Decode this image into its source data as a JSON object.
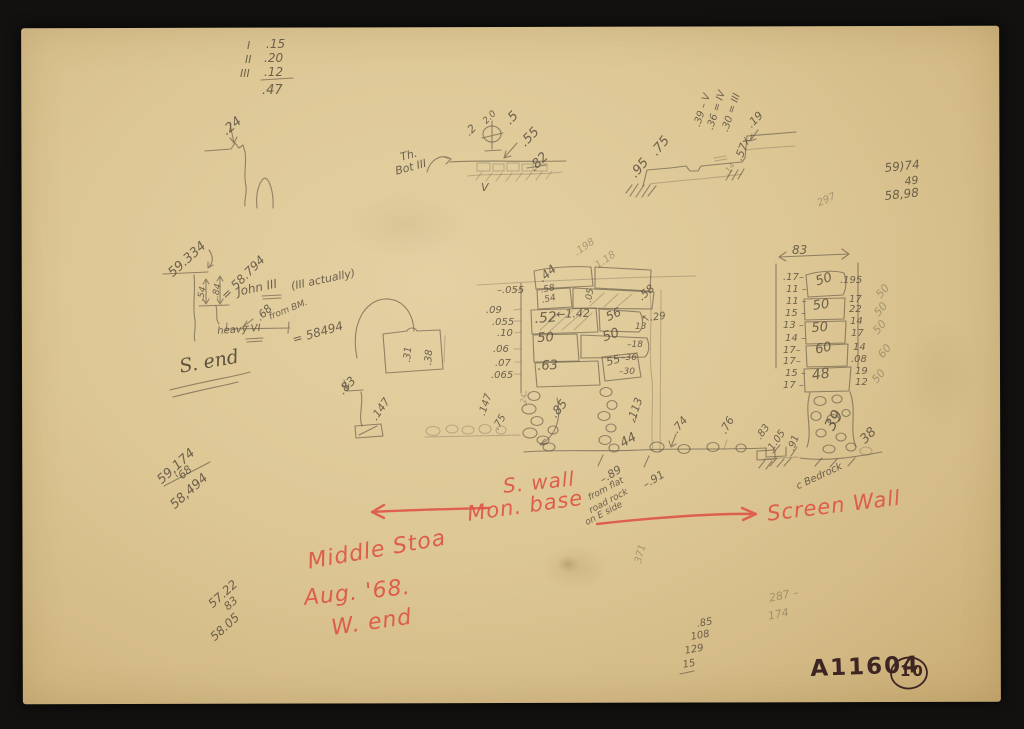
{
  "document": {
    "type": "scanned handwritten field-note sketch page",
    "catalog_number": "A11604",
    "page_number": "10",
    "red_labels": [
      "S. wall",
      "Mon. base",
      "Screen Wall",
      "Middle Stoa",
      "Aug. '68.",
      "W. end"
    ],
    "colors": {
      "paper": "#ddc795",
      "pencil": "#5e5344",
      "red": "#dd5244",
      "ink": "#3c2522",
      "background": "#12110f"
    }
  },
  "annotations": [
    {
      "t": "I",
      "x": 247,
      "y": 40,
      "s": 11
    },
    {
      "t": ".15",
      "x": 266,
      "y": 38,
      "s": 12
    },
    {
      "t": "II",
      "x": 245,
      "y": 54,
      "s": 11
    },
    {
      "t": ".20",
      "x": 264,
      "y": 52,
      "s": 12
    },
    {
      "t": "III",
      "x": 240,
      "y": 68,
      "s": 11
    },
    {
      "t": ".12",
      "x": 264,
      "y": 66,
      "s": 12
    },
    {
      "t": ".47",
      "x": 262,
      "y": 84,
      "s": 13
    },
    {
      "t": ".24",
      "x": 220,
      "y": 128,
      "r": -40,
      "s": 13
    },
    {
      "t": "Th.",
      "x": 399,
      "y": 152,
      "r": -15,
      "s": 11
    },
    {
      "t": "Bot III",
      "x": 394,
      "y": 166,
      "r": -15,
      "s": 11
    },
    {
      "t": ".2",
      "x": 463,
      "y": 130,
      "r": -45,
      "s": 11
    },
    {
      "t": "2.0",
      "x": 482,
      "y": 120,
      "r": -45,
      "s": 9
    },
    {
      "t": ".5",
      "x": 503,
      "y": 118,
      "r": -45,
      "s": 13
    },
    {
      "t": ".55",
      "x": 518,
      "y": 140,
      "r": -45,
      "s": 13
    },
    {
      "t": ".82",
      "x": 527,
      "y": 165,
      "r": -45,
      "s": 13
    },
    {
      "t": "V",
      "x": 481,
      "y": 182,
      "s": 11
    },
    {
      "t": ".95",
      "x": 628,
      "y": 172,
      "r": -50,
      "s": 13
    },
    {
      "t": ".75",
      "x": 649,
      "y": 150,
      "r": -50,
      "s": 13
    },
    {
      "t": ".39 – V",
      "x": 693,
      "y": 125,
      "r": -72,
      "s": 10
    },
    {
      "t": ".36 = IV",
      "x": 706,
      "y": 128,
      "r": -72,
      "s": 10
    },
    {
      "t": ".30 = III",
      "x": 721,
      "y": 130,
      "r": -72,
      "s": 10
    },
    {
      "t": ".57x",
      "x": 733,
      "y": 158,
      "r": -68,
      "s": 11
    },
    {
      "t": ".19",
      "x": 745,
      "y": 122,
      "r": -45,
      "s": 11
    },
    {
      "t": ".14",
      "x": 723,
      "y": 172,
      "r": -55,
      "s": 8,
      "c": "pf"
    },
    {
      "t": "59)74",
      "x": 884,
      "y": 162,
      "r": -6,
      "s": 12
    },
    {
      "t": "49",
      "x": 904,
      "y": 176,
      "r": -6,
      "s": 11
    },
    {
      "t": "58,98",
      "x": 884,
      "y": 190,
      "r": -6,
      "s": 12
    },
    {
      "t": "297",
      "x": 816,
      "y": 200,
      "r": -25,
      "s": 10,
      "c": "pf"
    },
    {
      "t": "59.334",
      "x": 166,
      "y": 270,
      "r": -42,
      "s": 13
    },
    {
      "t": ".54",
      "x": 197,
      "y": 300,
      "r": -78,
      "s": 9
    },
    {
      "t": ".84",
      "x": 212,
      "y": 297,
      "r": -78,
      "s": 9
    },
    {
      "t": "= 58.794",
      "x": 219,
      "y": 293,
      "r": -45,
      "s": 12
    },
    {
      "t": "John III",
      "x": 236,
      "y": 286,
      "r": -12,
      "s": 12
    },
    {
      "t": "(III actually)",
      "x": 290,
      "y": 281,
      "r": -12,
      "s": 11
    },
    {
      "t": ".68",
      "x": 254,
      "y": 315,
      "r": -45,
      "s": 11
    },
    {
      "t": "from BM.",
      "x": 268,
      "y": 314,
      "r": -22,
      "s": 9
    },
    {
      "t": "= 58494",
      "x": 291,
      "y": 334,
      "r": -16,
      "s": 12
    },
    {
      "t": "heavy VI",
      "x": 217,
      "y": 327,
      "r": -4,
      "s": 10
    },
    {
      "t": "S. end",
      "x": 178,
      "y": 358,
      "r": -10,
      "s": 19,
      "c": "ps",
      "n": "label-s-end"
    },
    {
      "t": ".31",
      "x": 403,
      "y": 362,
      "r": -85,
      "s": 10
    },
    {
      "t": ".38",
      "x": 424,
      "y": 365,
      "r": -85,
      "s": 10
    },
    {
      "t": ".83",
      "x": 336,
      "y": 388,
      "r": -45,
      "s": 12
    },
    {
      "t": ".147",
      "x": 369,
      "y": 416,
      "r": -55,
      "s": 11
    },
    {
      "t": "–.055",
      "x": 497,
      "y": 286,
      "s": 10
    },
    {
      "t": ".09",
      "x": 486,
      "y": 306,
      "s": 10
    },
    {
      "t": ".055",
      "x": 492,
      "y": 318,
      "s": 10
    },
    {
      "t": ".10",
      "x": 497,
      "y": 329,
      "s": 10
    },
    {
      "t": ".06",
      "x": 493,
      "y": 345,
      "s": 10
    },
    {
      "t": ".07",
      "x": 495,
      "y": 359,
      "s": 10
    },
    {
      "t": ".065",
      "x": 491,
      "y": 371,
      "s": 10
    },
    {
      "t": ".44",
      "x": 536,
      "y": 275,
      "r": -40,
      "s": 12
    },
    {
      "t": ".198",
      "x": 573,
      "y": 250,
      "r": -35,
      "s": 10,
      "c": "pf"
    },
    {
      "t": "1.18",
      "x": 594,
      "y": 263,
      "r": -35,
      "s": 10,
      "c": "pf"
    },
    {
      "t": ".58",
      "x": 540,
      "y": 287,
      "r": -12,
      "s": 9
    },
    {
      "t": ".54",
      "x": 541,
      "y": 297,
      "r": -12,
      "s": 9
    },
    {
      "t": ".05",
      "x": 585,
      "y": 302,
      "r": -80,
      "s": 9
    },
    {
      "t": ".52",
      "x": 534,
      "y": 312,
      "r": -4,
      "s": 14
    },
    {
      "t": "←1.42",
      "x": 556,
      "y": 309,
      "r": -2,
      "s": 11
    },
    {
      "t": "56",
      "x": 604,
      "y": 312,
      "r": -25,
      "s": 12
    },
    {
      "t": "↖.29",
      "x": 641,
      "y": 315,
      "r": -8,
      "s": 10
    },
    {
      "t": ".58",
      "x": 636,
      "y": 294,
      "r": -40,
      "s": 11
    },
    {
      "t": "50",
      "x": 537,
      "y": 332,
      "r": -3,
      "s": 13
    },
    {
      "t": "50",
      "x": 601,
      "y": 332,
      "r": -20,
      "s": 13
    },
    {
      "t": "13",
      "x": 635,
      "y": 323,
      "s": 9
    },
    {
      "t": "–18",
      "x": 627,
      "y": 341,
      "s": 9
    },
    {
      "t": ".63",
      "x": 537,
      "y": 360,
      "r": -3,
      "s": 13
    },
    {
      "t": "55",
      "x": 605,
      "y": 357,
      "r": -15,
      "s": 11
    },
    {
      "t": "–36",
      "x": 621,
      "y": 354,
      "s": 9
    },
    {
      "t": "–30",
      "x": 619,
      "y": 368,
      "s": 9
    },
    {
      "t": ".85",
      "x": 548,
      "y": 412,
      "r": -50,
      "s": 12
    },
    {
      "t": ".147",
      "x": 478,
      "y": 414,
      "r": -72,
      "s": 10
    },
    {
      "t": ".75",
      "x": 492,
      "y": 427,
      "r": -60,
      "s": 10
    },
    {
      "t": ".24",
      "x": 520,
      "y": 405,
      "r": -85,
      "s": 7,
      "c": "pf"
    },
    {
      "t": "113",
      "x": 627,
      "y": 416,
      "r": -70,
      "s": 11
    },
    {
      "t": "√",
      "x": 632,
      "y": 417,
      "s": 9
    },
    {
      "t": "44",
      "x": 618,
      "y": 439,
      "r": -30,
      "s": 13
    },
    {
      "t": ".74",
      "x": 670,
      "y": 428,
      "r": -50,
      "s": 11
    },
    {
      "t": ".76",
      "x": 718,
      "y": 430,
      "r": -60,
      "s": 11
    },
    {
      "t": ".83",
      "x": 755,
      "y": 436,
      "r": -55,
      "s": 10
    },
    {
      "t": "1.05",
      "x": 767,
      "y": 447,
      "r": -55,
      "s": 10
    },
    {
      "t": ".91",
      "x": 787,
      "y": 449,
      "r": -70,
      "s": 10
    },
    {
      "t": "–.89",
      "x": 598,
      "y": 476,
      "r": -32,
      "s": 11
    },
    {
      "t": "–.91",
      "x": 641,
      "y": 481,
      "r": -32,
      "s": 11
    },
    {
      "t": "from flat",
      "x": 587,
      "y": 495,
      "r": -28,
      "s": 9
    },
    {
      "t": "road rock",
      "x": 588,
      "y": 508,
      "r": -28,
      "s": 9
    },
    {
      "t": "on E side",
      "x": 584,
      "y": 520,
      "r": -28,
      "s": 9
    },
    {
      "t": "83",
      "x": 792,
      "y": 244,
      "s": 12
    },
    {
      "t": ".17–",
      "x": 783,
      "y": 273,
      "s": 10
    },
    {
      "t": "11 –",
      "x": 786,
      "y": 285,
      "s": 10
    },
    {
      "t": "11 –",
      "x": 786,
      "y": 297,
      "s": 10
    },
    {
      "t": "15 –",
      "x": 785,
      "y": 309,
      "s": 10
    },
    {
      "t": "13 –",
      "x": 783,
      "y": 321,
      "s": 10
    },
    {
      "t": "14 –",
      "x": 785,
      "y": 334,
      "s": 10
    },
    {
      "t": "17–",
      "x": 783,
      "y": 346,
      "s": 10
    },
    {
      "t": "17–",
      "x": 783,
      "y": 357,
      "s": 10
    },
    {
      "t": "15 –",
      "x": 785,
      "y": 369,
      "s": 10
    },
    {
      "t": "17 –",
      "x": 783,
      "y": 381,
      "s": 10
    },
    {
      "t": "50",
      "x": 814,
      "y": 276,
      "r": -18,
      "s": 13
    },
    {
      "t": "50",
      "x": 812,
      "y": 300,
      "r": -8,
      "s": 13
    },
    {
      "t": "50",
      "x": 811,
      "y": 322,
      "r": -4,
      "s": 13
    },
    {
      "t": "60",
      "x": 814,
      "y": 344,
      "r": -12,
      "s": 13
    },
    {
      "t": "48",
      "x": 811,
      "y": 369,
      "r": -8,
      "s": 14
    },
    {
      "t": "39",
      "x": 822,
      "y": 425,
      "r": -60,
      "s": 16
    },
    {
      "t": ".195",
      "x": 840,
      "y": 276,
      "s": 10
    },
    {
      "t": "17",
      "x": 849,
      "y": 295,
      "s": 10
    },
    {
      "t": "22",
      "x": 849,
      "y": 305,
      "s": 10
    },
    {
      "t": "14",
      "x": 850,
      "y": 317,
      "s": 10
    },
    {
      "t": "17",
      "x": 851,
      "y": 329,
      "s": 10
    },
    {
      "t": "14",
      "x": 853,
      "y": 343,
      "s": 10
    },
    {
      "t": ".08",
      "x": 851,
      "y": 355,
      "s": 10
    },
    {
      "t": "19",
      "x": 855,
      "y": 367,
      "s": 10
    },
    {
      "t": "12",
      "x": 855,
      "y": 378,
      "s": 10
    },
    {
      "t": "50",
      "x": 874,
      "y": 293,
      "r": -50,
      "s": 11,
      "c": "pf"
    },
    {
      "t": "50",
      "x": 872,
      "y": 311,
      "r": -50,
      "s": 11,
      "c": "pf"
    },
    {
      "t": "50",
      "x": 871,
      "y": 329,
      "r": -50,
      "s": 11,
      "c": "pf"
    },
    {
      "t": "60",
      "x": 876,
      "y": 353,
      "r": -50,
      "s": 11,
      "c": "pf"
    },
    {
      "t": "50",
      "x": 870,
      "y": 378,
      "r": -50,
      "s": 11,
      "c": "pf"
    },
    {
      "t": "38",
      "x": 858,
      "y": 437,
      "r": -45,
      "s": 13
    },
    {
      "t": "c Bedrock",
      "x": 795,
      "y": 483,
      "r": -25,
      "s": 10
    },
    {
      "t": "59,174",
      "x": 155,
      "y": 477,
      "r": -42,
      "s": 13
    },
    {
      "t": "'68",
      "x": 174,
      "y": 475,
      "r": -42,
      "s": 11
    },
    {
      "t": "58,494",
      "x": 168,
      "y": 502,
      "r": -42,
      "s": 13
    },
    {
      "t": "57.22",
      "x": 206,
      "y": 601,
      "r": -42,
      "s": 12
    },
    {
      "t": "83",
      "x": 222,
      "y": 604,
      "r": -42,
      "s": 11
    },
    {
      "t": "58.05",
      "x": 208,
      "y": 634,
      "r": -42,
      "s": 12
    },
    {
      "t": "287 –",
      "x": 768,
      "y": 593,
      "r": -12,
      "s": 11,
      "c": "pf"
    },
    {
      "t": "174",
      "x": 767,
      "y": 611,
      "r": -12,
      "s": 11,
      "c": "pf"
    },
    {
      "t": ".85",
      "x": 696,
      "y": 620,
      "r": -10,
      "s": 10
    },
    {
      "t": "108",
      "x": 690,
      "y": 633,
      "r": -10,
      "s": 10
    },
    {
      "t": "129",
      "x": 684,
      "y": 647,
      "r": -10,
      "s": 10
    },
    {
      "t": "15",
      "x": 682,
      "y": 661,
      "r": -10,
      "s": 10
    },
    {
      "t": "371",
      "x": 634,
      "y": 562,
      "r": -75,
      "s": 10,
      "c": "pf"
    },
    {
      "t": "S. wall",
      "x": 502,
      "y": 476,
      "r": -6,
      "s": 20,
      "c": "r",
      "n": "red-label-s-wall"
    },
    {
      "t": "Mon. base",
      "x": 466,
      "y": 504,
      "r": -8,
      "s": 21,
      "c": "r",
      "n": "red-label-mon-base"
    },
    {
      "t": "Screen Wall",
      "x": 766,
      "y": 504,
      "r": -7,
      "s": 21,
      "c": "r",
      "n": "red-label-screen-wall"
    },
    {
      "t": "Middle Stoa",
      "x": 306,
      "y": 552,
      "r": -10,
      "s": 22,
      "c": "r",
      "n": "red-label-middle-stoa"
    },
    {
      "t": "Aug. '68.",
      "x": 303,
      "y": 588,
      "r": -6,
      "s": 22,
      "c": "r",
      "n": "red-label-date"
    },
    {
      "t": "W. end",
      "x": 330,
      "y": 618,
      "r": -8,
      "s": 22,
      "c": "r",
      "n": "red-label-w-end"
    },
    {
      "t": "A11604",
      "x": 810,
      "y": 658,
      "r": -2,
      "s": 23,
      "c": "ink",
      "n": "catalog-number"
    },
    {
      "t": "10",
      "x": 900,
      "y": 664,
      "s": 15,
      "c": "ink",
      "n": "page-number"
    }
  ]
}
